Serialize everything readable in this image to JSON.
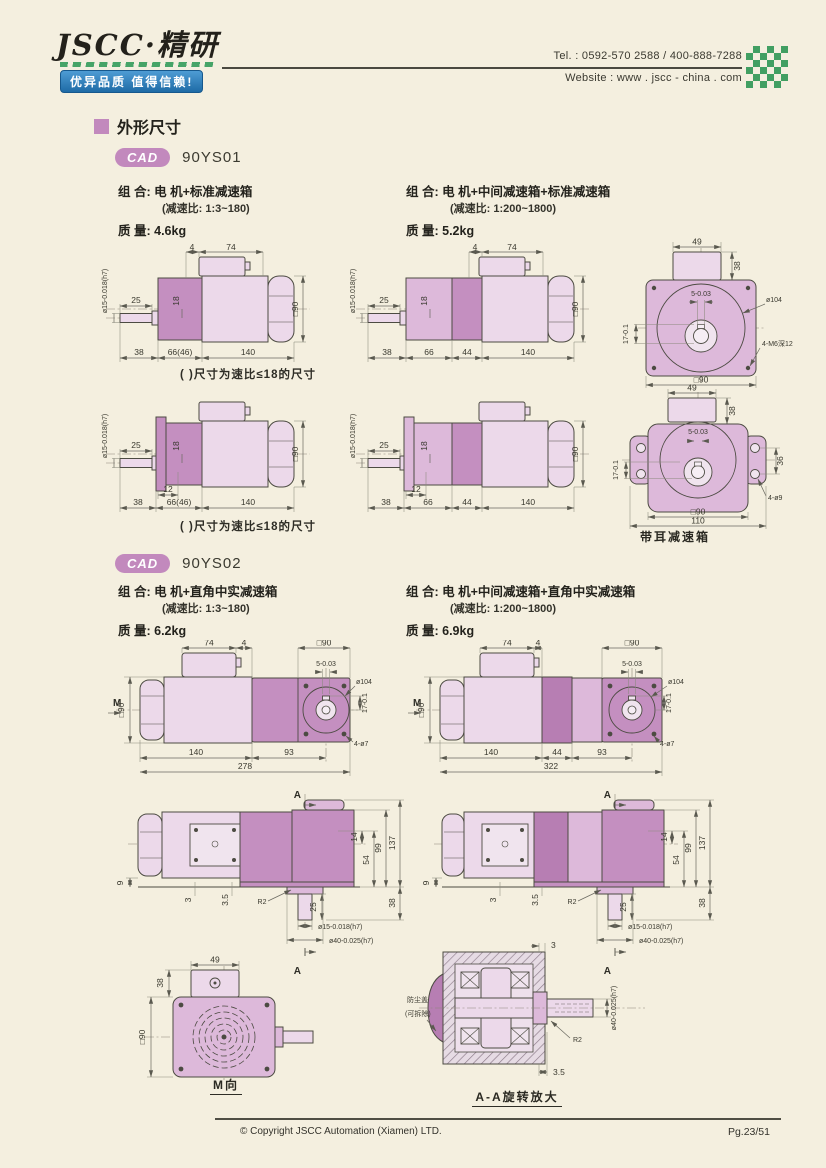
{
  "page": {
    "bg": "#f4efdf",
    "accent": "#c289bd",
    "blue": "#2b7cb9",
    "green": "#46a468",
    "ink": "#32312a"
  },
  "header": {
    "logo": "JSCC·精研",
    "slogan": "优异品质 值得信赖!",
    "tel": "Tel. : 0592-570 2588 / 400-888-7288",
    "website": "Website : www . jscc - china . com"
  },
  "section": {
    "title": "外形尺寸"
  },
  "ys01": {
    "badge": "CAD",
    "model": "90YS01",
    "combo_label": "组 合:",
    "mass_label": "质 量:",
    "left": {
      "combo": "电 机+标准减速箱",
      "ratio": "(减速比: 1:3~180)",
      "mass": "4.6kg"
    },
    "right": {
      "combo": "电 机+中间减速箱+标准减速箱",
      "ratio": "(减速比: 1:200~1800)",
      "mass": "5.2kg"
    },
    "note": "( )尺寸为速比≤18的尺寸"
  },
  "ys02": {
    "badge": "CAD",
    "model": "90YS02",
    "combo_label": "组 合:",
    "mass_label": "质 量:",
    "left": {
      "combo": "电 机+直角中实减速箱",
      "ratio": "(减速比: 1:3~180)",
      "mass": "6.2kg"
    },
    "right": {
      "combo": "电 机+中间减速箱+直角中实减速箱",
      "ratio": "(减速比: 1:200~1800)",
      "mass": "6.9kg"
    }
  },
  "dims": {
    "d1": {
      "t4": "4",
      "t74": "74",
      "s25": "25",
      "s18": "18",
      "shaft": "ø15-0.018(h7)",
      "sq90": "□90",
      "b1": "38",
      "b2": "66(46)",
      "b3": "140"
    },
    "d2": {
      "t4": "4",
      "t74": "74",
      "s25": "25",
      "s18": "18",
      "shaft": "ø15-0.018(h7)",
      "sq90": "□90",
      "b1": "38",
      "b2": "66",
      "b3": "44",
      "b4": "140"
    },
    "d3": {
      "t49": "49",
      "r38": "38",
      "dia": "ø104",
      "keyw": "5-0.03",
      "keyh": "17-0.1",
      "tap": "4-M6深12",
      "sq90": "□90"
    },
    "d4": {
      "s25": "25",
      "s18": "18",
      "k12": "12",
      "shaft": "ø15-0.018(h7)",
      "sq90": "□90",
      "b1": "38",
      "b2": "66(46)",
      "b3": "140"
    },
    "d5": {
      "s25": "25",
      "s18": "18",
      "k12": "12",
      "shaft": "ø15-0.018(h7)",
      "sq90": "□90",
      "b1": "38",
      "b2": "66",
      "b3": "44",
      "b4": "140"
    },
    "d6": {
      "t49": "49",
      "r38": "38",
      "keyw": "5-0.03",
      "keyh": "17-0.1",
      "v36": "36",
      "holes": "4-ø9",
      "sq90": "□90",
      "w110": "110",
      "caption": "带耳减速箱"
    },
    "d7": {
      "m": "M",
      "sq90s": "□90",
      "t74": "74",
      "t4": "4",
      "sq90t": "□90",
      "keyw": "5-0.03",
      "dia": "ø104",
      "keyh": "17-0.1",
      "holes": "4-ø7",
      "b1": "140",
      "b2": "93",
      "total": "278"
    },
    "d8": {
      "m": "M",
      "sq90s": "□90",
      "t74": "74",
      "t4": "4",
      "sq90t": "□90",
      "keyw": "5-0.03",
      "dia": "ø104",
      "keyh": "17-0.1",
      "holes": "4-ø7",
      "b1": "140",
      "b2": "44",
      "b3": "93",
      "total": "322"
    },
    "d9": {
      "a": "A",
      "h9": "9",
      "t3": "3",
      "t35": "3.5",
      "r2": "R2",
      "s25": "25",
      "shaft15": "ø15-0.018(h7)",
      "shaft40": "ø40-0.025(h7)",
      "r14": "14",
      "r54": "54",
      "r99": "99",
      "r137": "137",
      "r38": "38"
    },
    "d11": {
      "t49": "49",
      "r38": "38",
      "sq90": "□90",
      "caption": "M向"
    },
    "d12": {
      "t3": "3",
      "b35": "3.5",
      "r2": "R2",
      "shaft40": "ø40-0.025(h7)",
      "cover1": "防尘盖",
      "cover2": "(可拆除)",
      "caption": "A-A旋转放大"
    }
  },
  "footer": {
    "copyright": "© Copyright JSCC Automation (Xiamen) LTD.",
    "page": "Pg.23/51"
  }
}
